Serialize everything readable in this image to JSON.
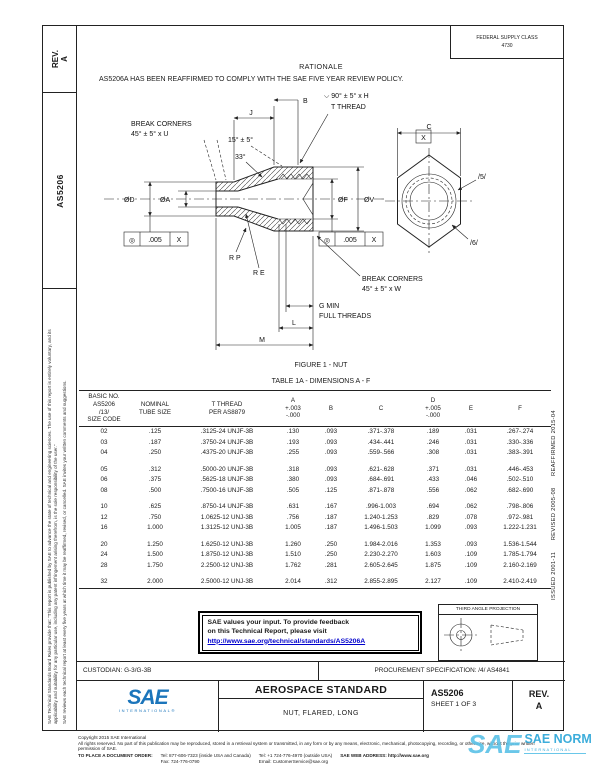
{
  "left_margin": {
    "rev_label": "REV.",
    "rev_value": "A",
    "doc_number": "AS5206",
    "disclaimer_1": "SAE Technical Standards Board Rules provide that: \"This report is published by SAE to advance the state of technical and engineering sciences. The use of this report is entirely voluntary, and its applicability and suitability for any particular use, including any patent infringement arising therefrom, is the sole responsibility of the user.\"",
    "disclaimer_2": "SAE reviews each technical report at least every five years at which time it may be reaffirmed, revised, or cancelled. SAE invites your written comments and suggestions."
  },
  "right_margin": {
    "history": "ISSUED 2001-11      REVISED 2005-08      REAFFIRMED 2015-04"
  },
  "header": {
    "fsc_line1": "FEDERAL SUPPLY CLASS",
    "fsc_line2": "4730",
    "rationale_title": "RATIONALE",
    "rationale_text": "AS5206A HAS BEEN REAFFIRMED TO COMPLY WITH THE SAE FIVE YEAR REVIEW POLICY."
  },
  "figure": {
    "caption": "FIGURE 1 - NUT",
    "labels": {
      "break_corners_left_1": "BREAK CORNERS",
      "break_corners_left_2": "45° ± 5° x U",
      "angle_15": "15° ± 5°",
      "angle_33": "33°",
      "csk_note_1": "⌵ 90° ± 5° x H",
      "csk_note_2": "T THREAD",
      "datum_x": "X",
      "dim_b": "B",
      "dim_j": "J",
      "dim_c": "C",
      "dia_d": "ØD",
      "dia_a": "ØA",
      "dia_f": "ØF",
      "dia_v": "ØV",
      "fcf_symbol": "◎",
      "fcf_tol": ".005",
      "fcf_datum": "X",
      "radius_p": "R P",
      "radius_e": "R E",
      "break_corners_right_1": "BREAK CORNERS",
      "break_corners_right_2": "45° ± 5° x W",
      "g_min": "G MIN",
      "full_threads": "FULL THREADS",
      "dim_l": "L",
      "dim_m": "M",
      "flag_5": "/5/",
      "flag_6": "/6/"
    }
  },
  "table": {
    "title": "TABLE 1A - DIMENSIONS A - F",
    "headers": [
      [
        "BASIC NO.",
        "AS5206",
        "/13/",
        "SIZE CODE"
      ],
      [
        "NOMINAL",
        "TUBE SIZE"
      ],
      [
        "T THREAD",
        "PER AS8879"
      ],
      [
        "A",
        "+.003",
        "-.000"
      ],
      [
        "B"
      ],
      [
        "C"
      ],
      [
        "D",
        "+.005",
        "-.000"
      ],
      [
        "E"
      ],
      [
        "F"
      ]
    ],
    "row_groups": [
      [
        [
          "02",
          ".125",
          ".3125-24 UNJF-3B",
          ".130",
          ".093",
          ".371-.378",
          ".189",
          ".031",
          ".267-.274"
        ],
        [
          "03",
          ".187",
          ".3750-24 UNJF-3B",
          ".193",
          ".093",
          ".434-.441",
          ".246",
          ".031",
          ".330-.336"
        ],
        [
          "04",
          ".250",
          ".4375-20 UNJF-3B",
          ".255",
          ".093",
          ".559-.566",
          ".308",
          ".031",
          ".383-.391"
        ]
      ],
      [
        [
          "05",
          ".312",
          ".5000-20 UNJF-3B",
          ".318",
          ".093",
          ".621-.628",
          ".371",
          ".031",
          ".446-.453"
        ],
        [
          "06",
          ".375",
          ".5625-18 UNJF-3B",
          ".380",
          ".093",
          ".684-.691",
          ".433",
          ".046",
          ".502-.510"
        ],
        [
          "08",
          ".500",
          ".7500-16 UNJF-3B",
          ".505",
          ".125",
          ".871-.878",
          ".556",
          ".062",
          ".682-.690"
        ]
      ],
      [
        [
          "10",
          ".625",
          ".8750-14 UNJF-3B",
          ".631",
          ".167",
          ".996-1.003",
          ".694",
          ".062",
          ".798-.806"
        ],
        [
          "12",
          ".750",
          "1.0625-12 UNJ-3B",
          ".756",
          ".187",
          "1.240-1.253",
          ".829",
          ".078",
          ".972-.981"
        ],
        [
          "16",
          "1.000",
          "1.3125-12 UNJ-3B",
          "1.005",
          ".187",
          "1.496-1.503",
          "1.099",
          ".093",
          "1.222-1.231"
        ]
      ],
      [
        [
          "20",
          "1.250",
          "1.6250-12 UNJ-3B",
          "1.260",
          ".250",
          "1.984-2.016",
          "1.353",
          ".093",
          "1.536-1.544"
        ],
        [
          "24",
          "1.500",
          "1.8750-12 UNJ-3B",
          "1.510",
          ".250",
          "2.230-2.270",
          "1.603",
          ".109",
          "1.785-1.794"
        ],
        [
          "28",
          "1.750",
          "2.2500-12 UNJ-3B",
          "1.762",
          ".281",
          "2.605-2.645",
          "1.875",
          ".109",
          "2.160-2.169"
        ]
      ],
      [
        [
          "32",
          "2.000",
          "2.5000-12 UNJ-3B",
          "2.014",
          ".312",
          "2.855-2.895",
          "2.127",
          ".109",
          "2.410-2.419"
        ]
      ]
    ]
  },
  "feedback_box": {
    "line1": "SAE values your input. To provide feedback",
    "line2": "on this Technical Report, please visit",
    "link": "http://www.sae.org/technical/standards/AS5206A"
  },
  "projection_box": {
    "title": "THIRD ANGLE PROJECTION"
  },
  "band": {
    "custodian": "CUSTODIAN: G-3/G-3B",
    "procurement": "PROCUREMENT SPECIFICATION: /4/ AS4841"
  },
  "title_block": {
    "logo_text": "SAE",
    "logo_sub": "INTERNATIONAL®",
    "standard_type": "AEROSPACE STANDARD",
    "title": "NUT, FLARED, LONG",
    "number": "AS5206",
    "sheet": "SHEET 1 OF 3",
    "rev_label": "REV.",
    "rev_value": "A"
  },
  "footer": {
    "copyright": "Copyright 2015 SAE International",
    "rights": "All rights reserved. No part of this publication may be reproduced, stored in a retrieval system or transmitted, in any form or by any means, electronic, mechanical, photocopying, recording, or otherwise, without the prior written permission of SAE.",
    "order_label": "TO PLACE A DOCUMENT ORDER:",
    "tel_us": "Tel: 877-606-7323 (inside USA and Canada)",
    "fax": "Fax: 724-776-0790",
    "tel_intl": "Tel: +1 724-776-4970 (outside USA)",
    "email": "Email: CustomerService@sae.org",
    "web": "SAE WEB ADDRESS: http://www.sae.org"
  },
  "watermark": {
    "logo": "SAE",
    "title": "SAE NORM",
    "subtitle": "INTERNATIONAL"
  },
  "colors": {
    "link_blue": "#0000cc",
    "sae_blue": "#1b75bb",
    "watermark_blue": "#5ec3e8"
  }
}
